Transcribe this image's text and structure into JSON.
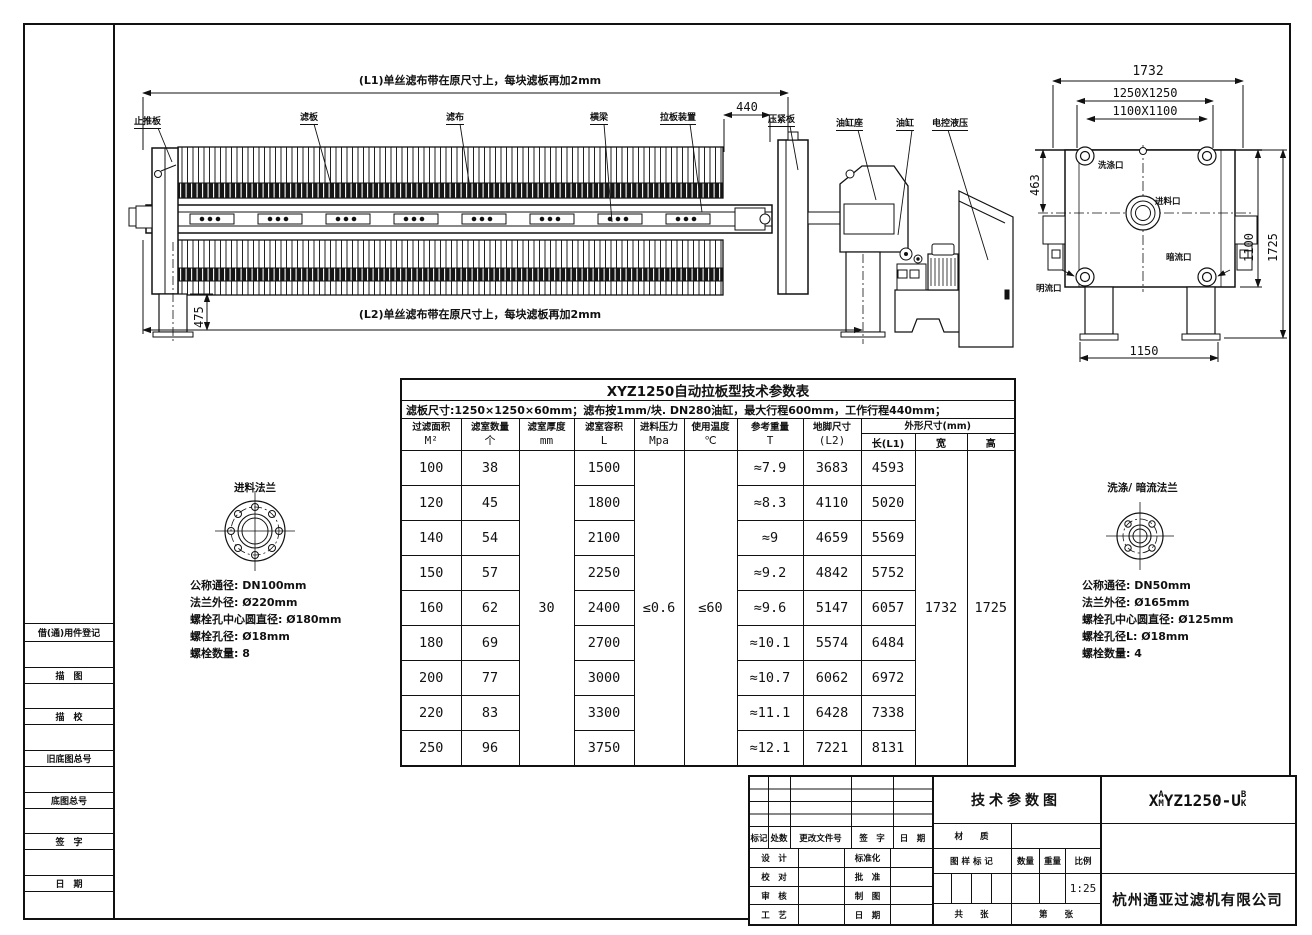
{
  "side_view": {
    "dim_l1_text": "(L1)单丝滤布带在原尺寸上，每块滤板再加2mm",
    "dim_l2_text": "(L2)单丝滤布带在原尺寸上，每块滤板再加2mm",
    "dim_440": "440",
    "dim_475": "475",
    "labels": {
      "thrust_plate": "止推板",
      "filter_plate": "滤板",
      "filter_cloth": "滤布",
      "main_beam": "横梁",
      "plate_shifter": "拉板装置",
      "press_plate": "压紧板",
      "cylinder_seat": "油缸座",
      "cylinder": "油缸",
      "electric_hydraulic": "电控液压"
    }
  },
  "end_view": {
    "dim_1732": "1732",
    "dim_1250": "1250X1250",
    "dim_1100_sq": "1100X1100",
    "dim_463": "463",
    "dim_1100": "1100",
    "dim_1725": "1725",
    "dim_1150": "1150",
    "ports": {
      "wash": "洗涤口",
      "feed": "进料口",
      "dark": "暗流口",
      "open": "明流口"
    }
  },
  "feed_flange": {
    "title": "进料法兰",
    "lines": [
      "公称通径: DN100mm",
      "法兰外径: Ø220mm",
      "螺栓孔中心圆直径: Ø180mm",
      "螺栓孔径: Ø18mm",
      "螺栓数量: 8"
    ]
  },
  "wash_flange": {
    "title": "洗涤/ 暗流法兰",
    "lines": [
      "公称通径: DN50mm",
      "法兰外径: Ø165mm",
      "螺栓孔中心圆直径: Ø125mm",
      "螺栓孔径L: Ø18mm",
      "螺栓数量: 4"
    ]
  },
  "params_table": {
    "title": "XYZ1250自动拉板型技术参数表",
    "spec_line": "滤板尺寸:1250×1250×60mm；滤布按1mm/块. DN280油缸，最大行程600mm，工作行程440mm；",
    "headers": [
      {
        "name": "过滤面积",
        "unit": "M²"
      },
      {
        "name": "滤室数量",
        "unit": "个"
      },
      {
        "name": "滤室厚度",
        "unit": "mm"
      },
      {
        "name": "滤室容积",
        "unit": "L"
      },
      {
        "name": "进料压力",
        "unit": "Mpa"
      },
      {
        "name": "使用温度",
        "unit": "℃"
      },
      {
        "name": "参考重量",
        "unit": "T"
      },
      {
        "name": "地脚尺寸",
        "unit": "(L2)"
      }
    ],
    "dim_header": "外形尺寸(mm)",
    "sub_headers": [
      "长(L1)",
      "宽",
      "高"
    ],
    "merged": {
      "thickness": "30",
      "pressure": "≤0.6",
      "temperature": "≤60",
      "width": "1732",
      "height": "1725"
    },
    "rows": [
      [
        "100",
        "38",
        "1500",
        "≈7.9",
        "3683",
        "4593"
      ],
      [
        "120",
        "45",
        "1800",
        "≈8.3",
        "4110",
        "5020"
      ],
      [
        "140",
        "54",
        "2100",
        "≈9",
        "4659",
        "5569"
      ],
      [
        "150",
        "57",
        "2250",
        "≈9.2",
        "4842",
        "5752"
      ],
      [
        "160",
        "62",
        "2400",
        "≈9.6",
        "5147",
        "6057"
      ],
      [
        "180",
        "69",
        "2700",
        "≈10.1",
        "5574",
        "6484"
      ],
      [
        "200",
        "77",
        "3000",
        "≈10.7",
        "6062",
        "6972"
      ],
      [
        "220",
        "83",
        "3300",
        "≈11.1",
        "6428",
        "7338"
      ],
      [
        "250",
        "96",
        "3750",
        "≈12.1",
        "7221",
        "8131"
      ]
    ]
  },
  "left_margin": {
    "labels": [
      "借(通)用件登记",
      "描　图",
      "描　校",
      "旧底图总号",
      "底图总号",
      "签　字",
      "日　期"
    ]
  },
  "title_block": {
    "doc_title": "技术参数图",
    "drawing_no": {
      "p1": "X",
      "sup1": "A",
      "sub1": "M",
      "p2": "YZ1250-U",
      "sup2": "B",
      "sub2": "K"
    },
    "company": "杭州通亚过滤机有限公司",
    "scale_value": "1:25",
    "rev_headers": [
      "标记",
      "处数",
      "更改文件号",
      "签　字",
      "日　期"
    ],
    "roles": [
      [
        "设　计",
        "标准化"
      ],
      [
        "校　对",
        "批　准"
      ],
      [
        "审　核",
        "制　图"
      ],
      [
        "工　艺",
        "日　期"
      ]
    ],
    "material_label": "材　　质",
    "drawing_mark_label": "图 样 标 记",
    "qty_label": "数量",
    "weight_label": "重量",
    "scale_label": "比例",
    "total_label": "共　　张",
    "page_label": "第　　张"
  }
}
